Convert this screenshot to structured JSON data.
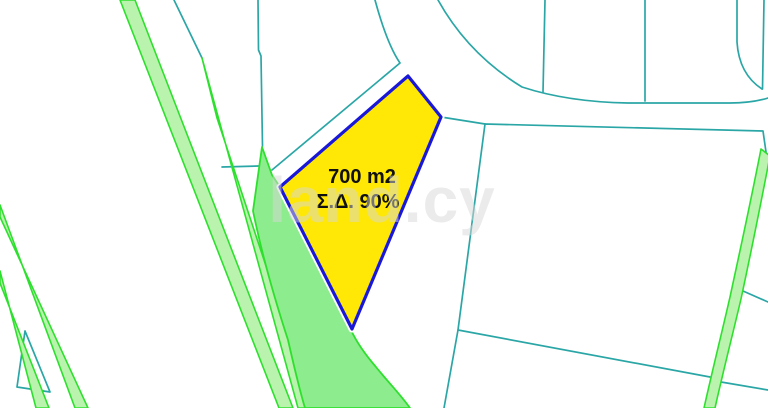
{
  "map": {
    "plot_label": {
      "area": "700 m2",
      "density": "Σ.Δ. 90%"
    },
    "watermark": "land.cy"
  },
  "colors": {
    "background": "#ffffff",
    "boundary_teal": "#2ba6a6",
    "road_green_stroke": "#2ee02e",
    "road_green_fill": "#8dec8d",
    "strip_green_fill": "#baf3ae",
    "plot_fill": "#ffe805",
    "plot_stroke": "#1a18d8",
    "plot_halo": "#ffffff",
    "label_text": "#101010",
    "watermark_text": "#d7d7d7"
  }
}
